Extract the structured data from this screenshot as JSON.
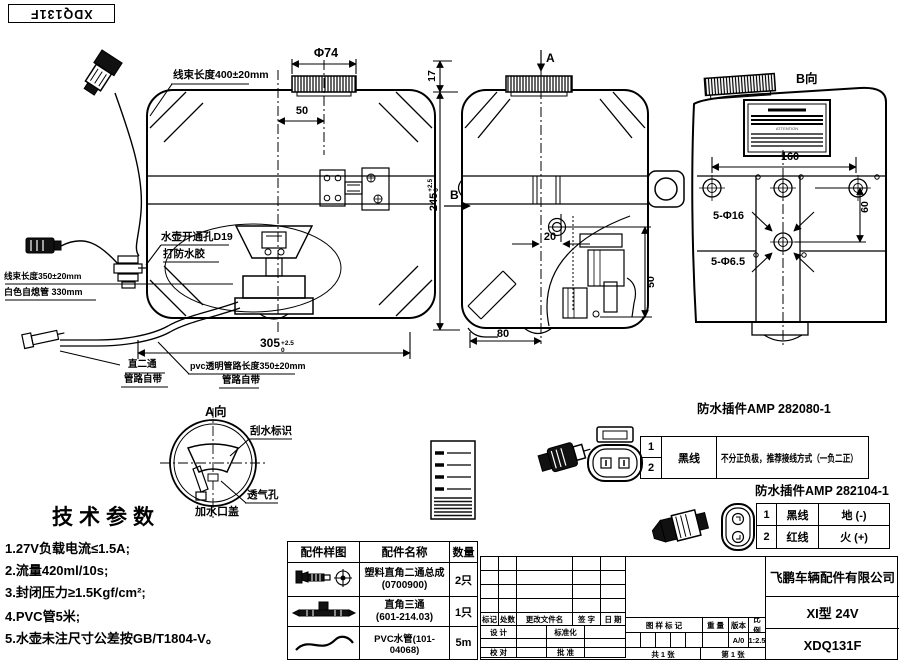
{
  "stamp": {
    "text": "XDQ131F"
  },
  "fv": {
    "harness_400": "线束长度400±20mm",
    "cap_dia": "Φ74",
    "dim_50": "50",
    "dim_17": "17",
    "dim_245": "245",
    "tol_up": "+2.5",
    "tol_dn": "0",
    "hole_line1": "水壶开通孔D19",
    "hole_line2": "打防水胶",
    "harness_350": "线束长度350±20mm",
    "white_tube": "白色自熄管 330mm",
    "dim_305": "305",
    "dim305_tol_up": "+2.5",
    "dim305_tol_dn": "0",
    "tee_line1": "直二通",
    "tee_line2": "管路自带",
    "pvc_line1": "pvc透明管路长度350±20mm",
    "pvc_line2": "管路自带"
  },
  "sv": {
    "label_a": "A",
    "label_b": "B",
    "dim_20": "20",
    "dim_50": "50",
    "dim_80": "80"
  },
  "bv": {
    "title": "B向",
    "dim_160": "160",
    "dim_60": "60",
    "holes_16": "5-Φ16",
    "holes_65": "5-Φ6.5",
    "attention": "ATTENTION"
  },
  "av": {
    "title": "A向",
    "wiper": "刮水标识",
    "vent": "透气孔",
    "cap": "加水口盖"
  },
  "tech": {
    "title": "技术参数",
    "items": [
      "1.27V负载电流≤1.5A;",
      "2.流量420ml/10s;",
      "3.封闭压力≥1.5Kgf/cm²;",
      "4.PVC管5米;",
      "5.水壶未注尺寸公差按GB/T1804-V。"
    ]
  },
  "parts": {
    "headers": [
      "配件样图",
      "配件名称",
      "数量"
    ],
    "rows": [
      {
        "name1": "塑料直角二通总成",
        "name2": "(0700900)",
        "qty": "2只"
      },
      {
        "name1": "直角三通",
        "name2": "(601-214.03)",
        "qty": "1只"
      },
      {
        "name1": "PVC水管(101-04068)",
        "name2": "",
        "qty": "5m"
      }
    ]
  },
  "conn1": {
    "title": "防水插件AMP 282080-1",
    "pin1": "1",
    "pin2": "2",
    "wire": "黑线",
    "note": "不分正负极，推荐接线方式（一负二正）"
  },
  "conn2": {
    "title": "防水插件AMP 282104-1",
    "rows": [
      {
        "pin": "1",
        "wire": "黑线",
        "desc": "地 (-)"
      },
      {
        "pin": "2",
        "wire": "红线",
        "desc": "火 (+)"
      }
    ]
  },
  "tb": {
    "company": "飞鹏车辆配件有限公司",
    "model": "XI型 24V",
    "number": "XDQ131F",
    "mark": "标记",
    "count": "处数",
    "file": "更改文件名",
    "sign": "签 字",
    "date": "日 期",
    "design": "设 计",
    "std": "标准化",
    "check": "校 对",
    "approve": "批 准",
    "sample_mark": "图 样 标 记",
    "weight": "重 量",
    "version": "版本",
    "scale": "比 例",
    "version_val": "A/0",
    "scale_val": "1:2.5",
    "sheet_total": "共 1 张",
    "sheet_no": "第 1 张"
  }
}
